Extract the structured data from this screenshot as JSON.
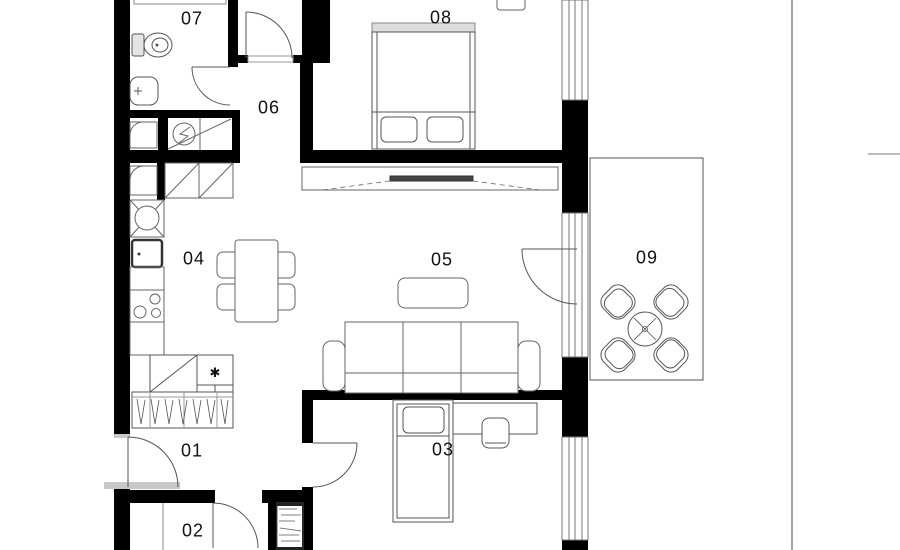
{
  "plan": {
    "type": "apartment-floor-plan",
    "rooms": [
      {
        "id": "room-01",
        "label": "01"
      },
      {
        "id": "room-02",
        "label": "02"
      },
      {
        "id": "room-03",
        "label": "03"
      },
      {
        "id": "room-04",
        "label": "04"
      },
      {
        "id": "room-05",
        "label": "05"
      },
      {
        "id": "room-06",
        "label": "06"
      },
      {
        "id": "room-07",
        "label": "07"
      },
      {
        "id": "room-08",
        "label": "08"
      },
      {
        "id": "room-09",
        "label": "09"
      }
    ],
    "symbols": {
      "closet_marker": "✱"
    },
    "colors": {
      "wall": "#000000",
      "furniture_line": "#555555",
      "light_line": "#999999",
      "threshold_fill": "#c8c8c8",
      "headboard_fill": "#dcdcdc",
      "tv_fill": "#444444",
      "label_text": "#111111",
      "background": "#ffffff"
    }
  }
}
